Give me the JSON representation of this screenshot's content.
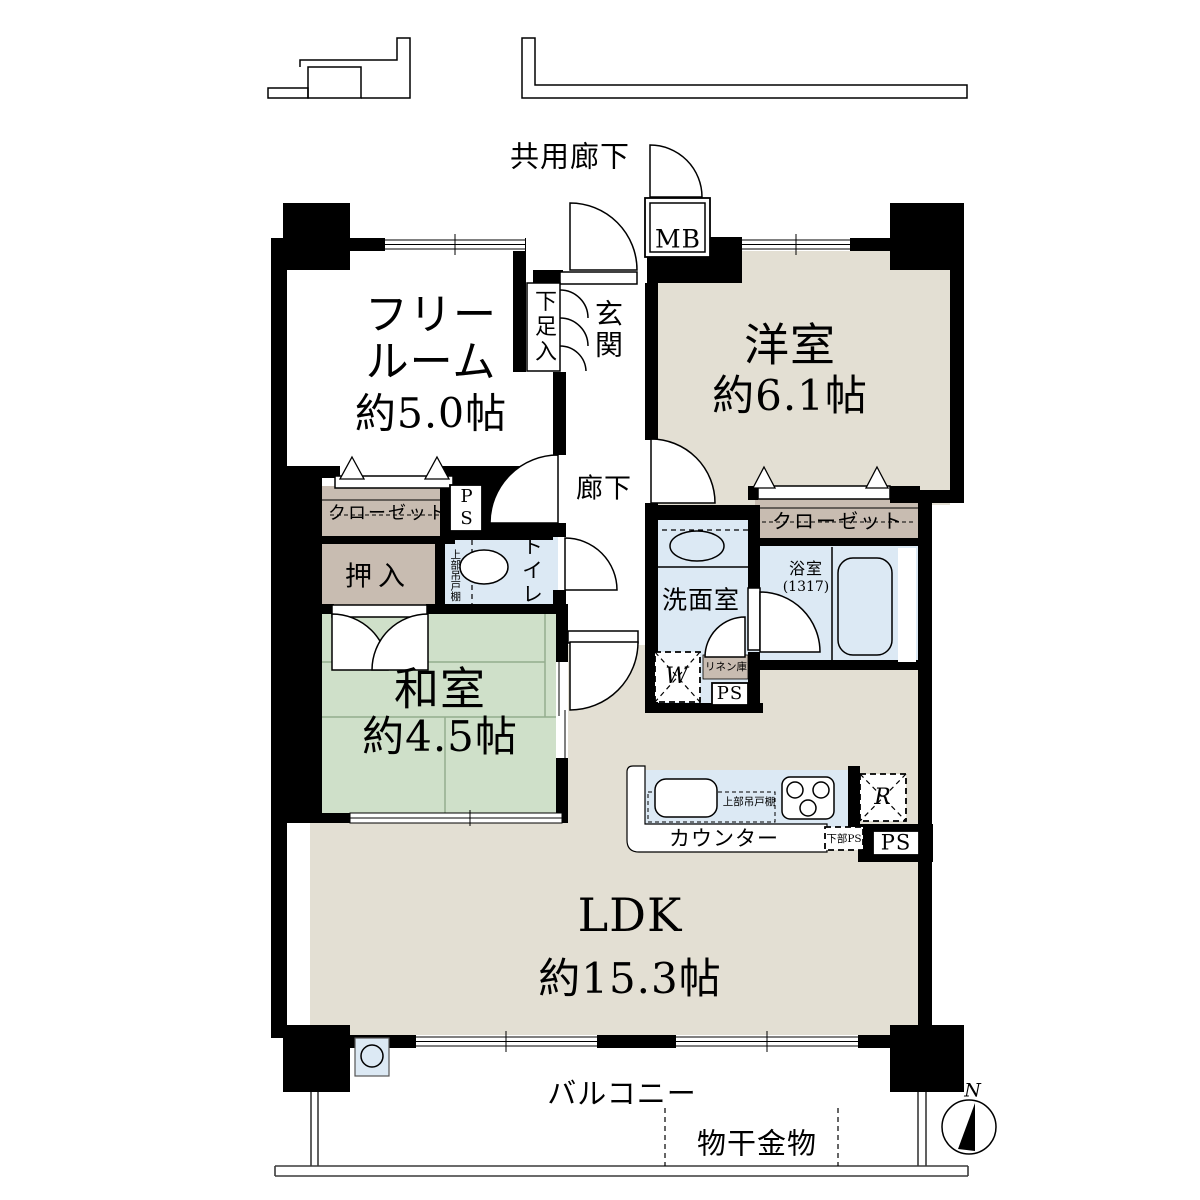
{
  "header": {
    "common_corridor": "共用廊下"
  },
  "rooms": {
    "free_room": {
      "name_line1": "フリー",
      "name_line2": "ルーム",
      "area": "約5.0帖"
    },
    "entrance": {
      "name": "玄関"
    },
    "western_room": {
      "name": "洋室",
      "area": "約6.1帖"
    },
    "corridor": {
      "name": "廊下"
    },
    "japanese_room": {
      "name": "和室",
      "area": "約4.5帖"
    },
    "washroom": {
      "name": "洗面室"
    },
    "bathroom": {
      "name": "浴室",
      "size": "(1317)"
    },
    "toilet": {
      "name": "トイレ"
    },
    "ldk": {
      "name": "LDK",
      "area": "約15.3帖"
    },
    "balcony": {
      "name": "バルコニー",
      "drying_fixture": "物干金物"
    }
  },
  "storage": {
    "closet_left": "クローゼット",
    "closet_right": "クローゼット",
    "oshiire": "押入",
    "shoe_cabinet": "下足入",
    "linen_cabinet": "リネン庫",
    "upper_cabinet": "上部吊戸棚"
  },
  "equipment": {
    "meter_box": "MB",
    "pipe_space": "PS",
    "lower_pipe_space": "下部PS",
    "washer": "W",
    "refrigerator": "R",
    "counter": "カウンター"
  },
  "compass": {
    "north": "N"
  },
  "colors": {
    "wall": "#000000",
    "beige": "#e3dfd3",
    "green": "#cfe0c9",
    "brown": "#c8bcb1",
    "blue": "#dce9f4",
    "outline": "#3a3a3a"
  }
}
